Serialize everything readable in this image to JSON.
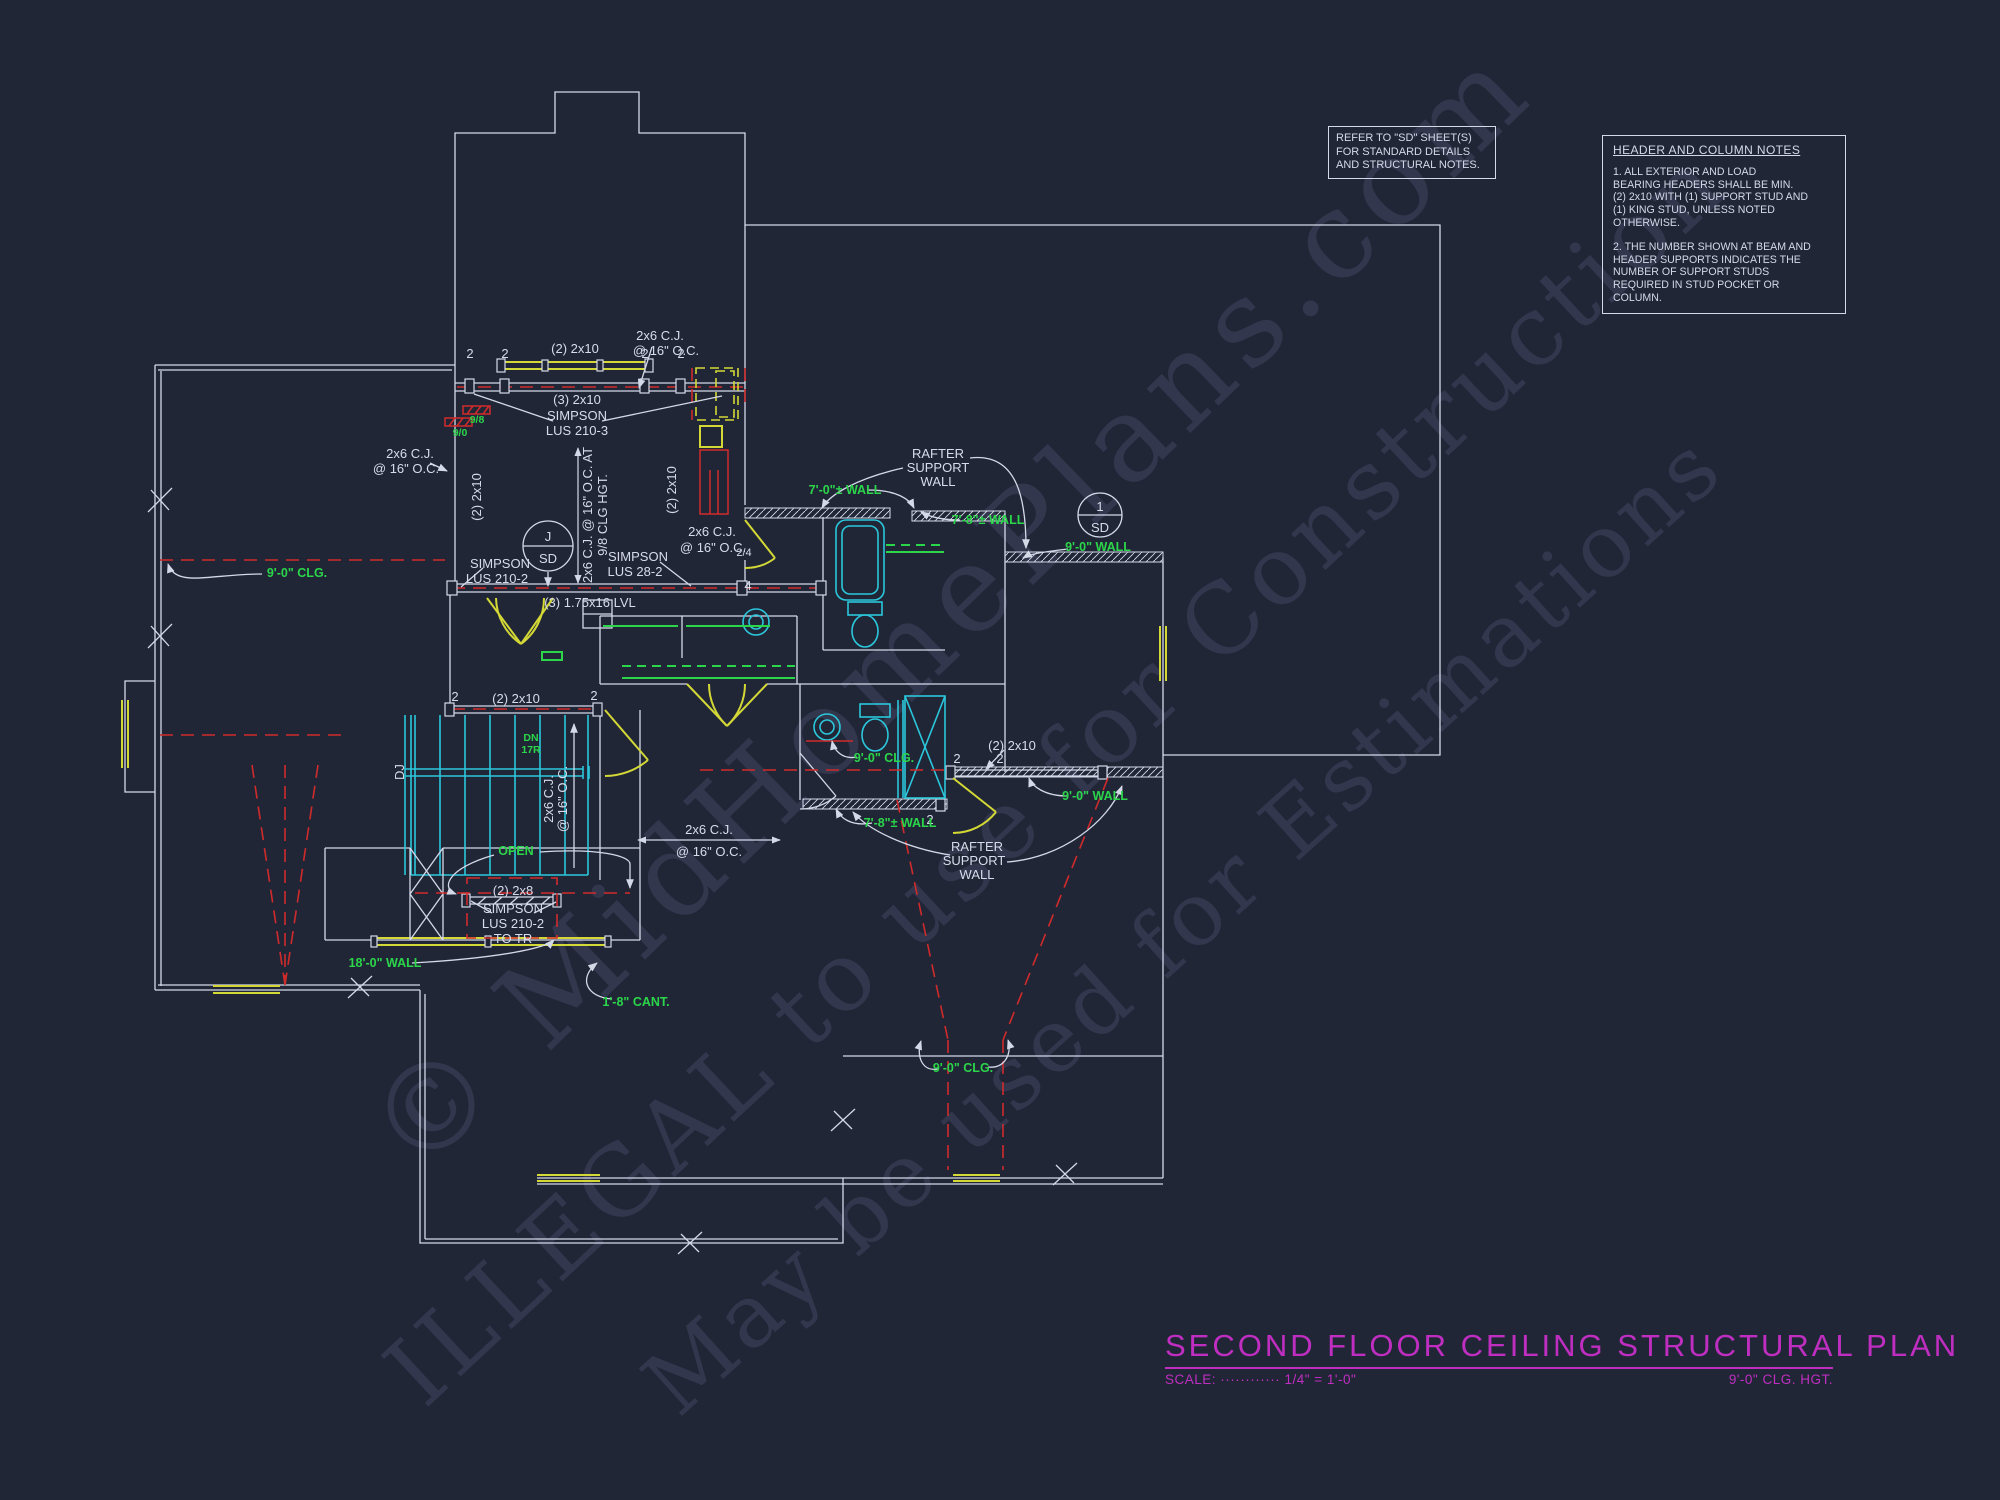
{
  "sheet": {
    "bg_color": "#212637"
  },
  "colors": {
    "line": "#d4d9e8",
    "cyan": "#2bc7db",
    "yellow": "#d3d836",
    "red": "#cf2b2b",
    "green": "#2bd64a",
    "magenta": "#bf2ec0",
    "watermark": "#8c98c8"
  },
  "refer_note": {
    "lines": [
      "REFER TO \"SD\" SHEET(S)",
      "FOR STANDARD DETAILS",
      "AND STRUCTURAL NOTES."
    ]
  },
  "header_notes": {
    "title": "HEADER AND COLUMN NOTES",
    "p1": [
      "1. ALL EXTERIOR AND LOAD",
      "BEARING HEADERS SHALL BE MIN.",
      "(2) 2x10 WITH (1) SUPPORT STUD AND",
      "(1) KING STUD, UNLESS NOTED",
      "OTHERWISE."
    ],
    "p2": [
      "2. THE NUMBER SHOWN AT BEAM AND",
      "HEADER SUPPORTS INDICATES THE",
      "NUMBER OF SUPPORT STUDS",
      "REQUIRED IN STUD POCKET OR",
      "COLUMN."
    ]
  },
  "title_block": {
    "title": "SECOND FLOOR CEILING STRUCTURAL PLAN",
    "scale": "SCALE: ············ 1/4\" = 1'-0\"",
    "ceiling": "9'-0\" CLG. HGT."
  },
  "watermark": {
    "line1": "© MidHomePlans.com",
    "line2": "ILLEGAL to use for Construction",
    "line3": "May be used for Estimations"
  },
  "labels": {
    "cj": "2x6 C.J.",
    "oc": "@ 16\" O.C.",
    "cj_at": "2x6 C.J. @ 16\" O.C. AT",
    "clg98": "9/8 CLG HGT.",
    "b2x10": "(2) 2x10",
    "b3x10": "(3) 2x10",
    "b2x8": "(2) 2x8",
    "lvl": "(3) 1.75x16 LVL",
    "simpson": "SIMPSON",
    "lus2103": "LUS 210-3",
    "lus2102": "LUS 210-2",
    "lus282": "LUS 28-2",
    "to_tr": "TO TR",
    "n2": "2",
    "n4": "4",
    "frac24": "2/4",
    "rafter": "RAFTER",
    "support": "SUPPORT",
    "wall": "WALL",
    "j": "J",
    "one": "1",
    "sd": "SD",
    "dj": "DJ",
    "dn": "DN",
    "risers": "17R",
    "open": "OPEN",
    "wall18": "18'-0\" WALL",
    "cant18": "1'-8\" CANT.",
    "wall70": "7'-0\"± WALL",
    "wall78": "7'-8\"± WALL",
    "wall90": "9'-0\" WALL",
    "clg90": "9'-0\" CLG.",
    "tag98": "9/8",
    "tag90": "9/0"
  }
}
